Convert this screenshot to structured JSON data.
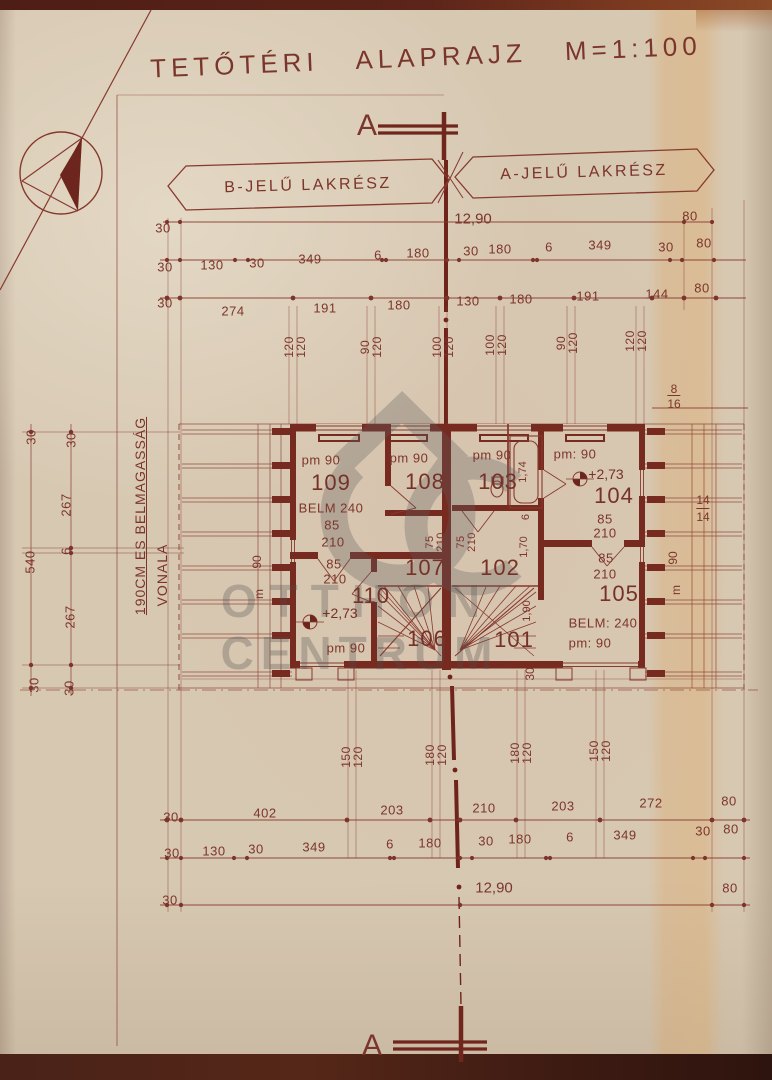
{
  "title": "TETŐTÉRI ALAPRAJZ M=1:100",
  "section_marker": "A",
  "banners": {
    "b": "B-JELŰ LAKRÉSZ",
    "a": "A-JELŰ LAKRÉSZ"
  },
  "overall_width": "12,90",
  "note": {
    "line1": "190CM ES BELMAGASSÁG",
    "line2": "VONALA"
  },
  "watermark": {
    "line1": "OTTHON",
    "line2": "CENTRUM"
  },
  "colors": {
    "ink": "#7d352b",
    "wall": "#772a20",
    "paper": "#d7c8b2"
  },
  "rooms": {
    "r101": {
      "num": "101"
    },
    "r102": {
      "num": "102",
      "w1": "1,70",
      "w2": "1,90"
    },
    "r103": {
      "num": "103",
      "pm": "pm 90",
      "tub": "1,74",
      "d6": "6"
    },
    "r104": {
      "num": "104",
      "pm": "pm: 90",
      "level": "+2,73",
      "door_w": "85",
      "door_h": "210"
    },
    "r105": {
      "num": "105",
      "belm": "BELM: 240",
      "pm": "pm: 90",
      "door_w": "85",
      "door_h": "210"
    },
    "r106": {
      "num": "106"
    },
    "r107": {
      "num": "107"
    },
    "r108": {
      "num": "108",
      "pm": "pm 90"
    },
    "r109": {
      "num": "109",
      "pm": "pm 90",
      "belm": "BELM 240",
      "door_w": "85",
      "door_h": "210"
    },
    "r110": {
      "num": "110",
      "level": "+2,73",
      "pm": "pm 90",
      "door_w": "85",
      "door_h": "210",
      "d30": "30"
    }
  },
  "door_pair": {
    "w": "75",
    "h": "210"
  },
  "dims": {
    "top": {
      "row1": [
        "30",
        "80"
      ],
      "row2": [
        "30",
        "130",
        "30",
        "349",
        "6",
        "180",
        "30",
        "180",
        "6",
        "349",
        "30",
        "80"
      ],
      "row3": [
        "30",
        "274",
        "191",
        "180",
        "130",
        "180",
        "191",
        "144",
        "80"
      ],
      "vpairs": [
        [
          "120",
          "120"
        ],
        [
          "90",
          "120"
        ],
        [
          "100",
          "120"
        ],
        [
          "100",
          "120"
        ],
        [
          "90",
          "120"
        ],
        [
          "120",
          "120"
        ]
      ]
    },
    "left": [
      "30",
      "30",
      "267",
      "6",
      "540",
      "267",
      "30",
      "30"
    ],
    "right": {
      "frac_top": "8",
      "frac_bot": "16",
      "p14a": "14",
      "p14b": "14",
      "n90": "90",
      "m": "m"
    },
    "left_inner": {
      "n90": "90",
      "m": "m"
    },
    "bottom": {
      "vpairs": [
        [
          "150",
          "120"
        ],
        [
          "180",
          "120"
        ],
        [
          "180",
          "120"
        ],
        [
          "150",
          "120"
        ]
      ],
      "row1": [
        "30",
        "402",
        "203",
        "210",
        "203",
        "272",
        "80"
      ],
      "row2": [
        "30",
        "130",
        "30",
        "349",
        "6",
        "180",
        "30",
        "180",
        "6",
        "349",
        "30",
        "80"
      ],
      "row3": [
        "30",
        "12,90",
        "80"
      ]
    }
  }
}
